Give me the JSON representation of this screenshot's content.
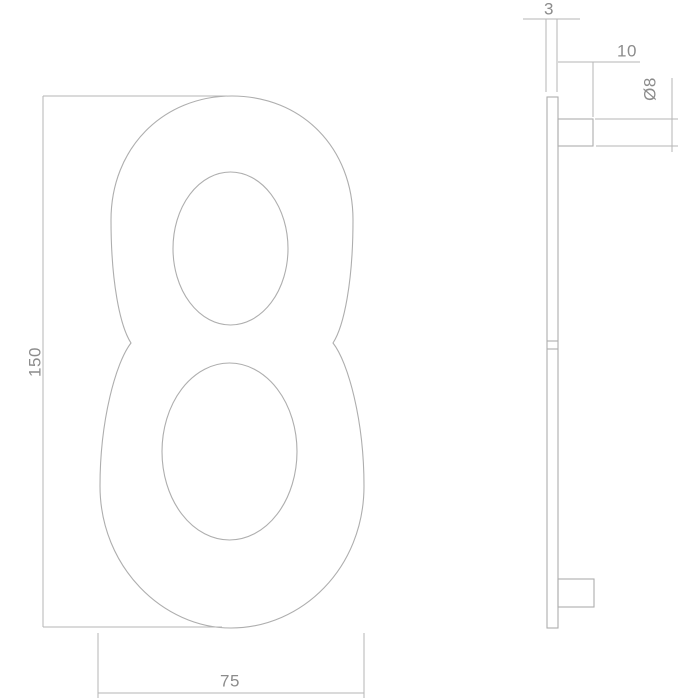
{
  "colors": {
    "background": "#ffffff",
    "line": "#b6b6b6",
    "text": "#8c8c8c"
  },
  "front_view": {
    "height_label": "150",
    "width_label": "75"
  },
  "side_view": {
    "thickness_label": "3",
    "pin_length_label": "10",
    "pin_diameter_label": "Ø8"
  }
}
